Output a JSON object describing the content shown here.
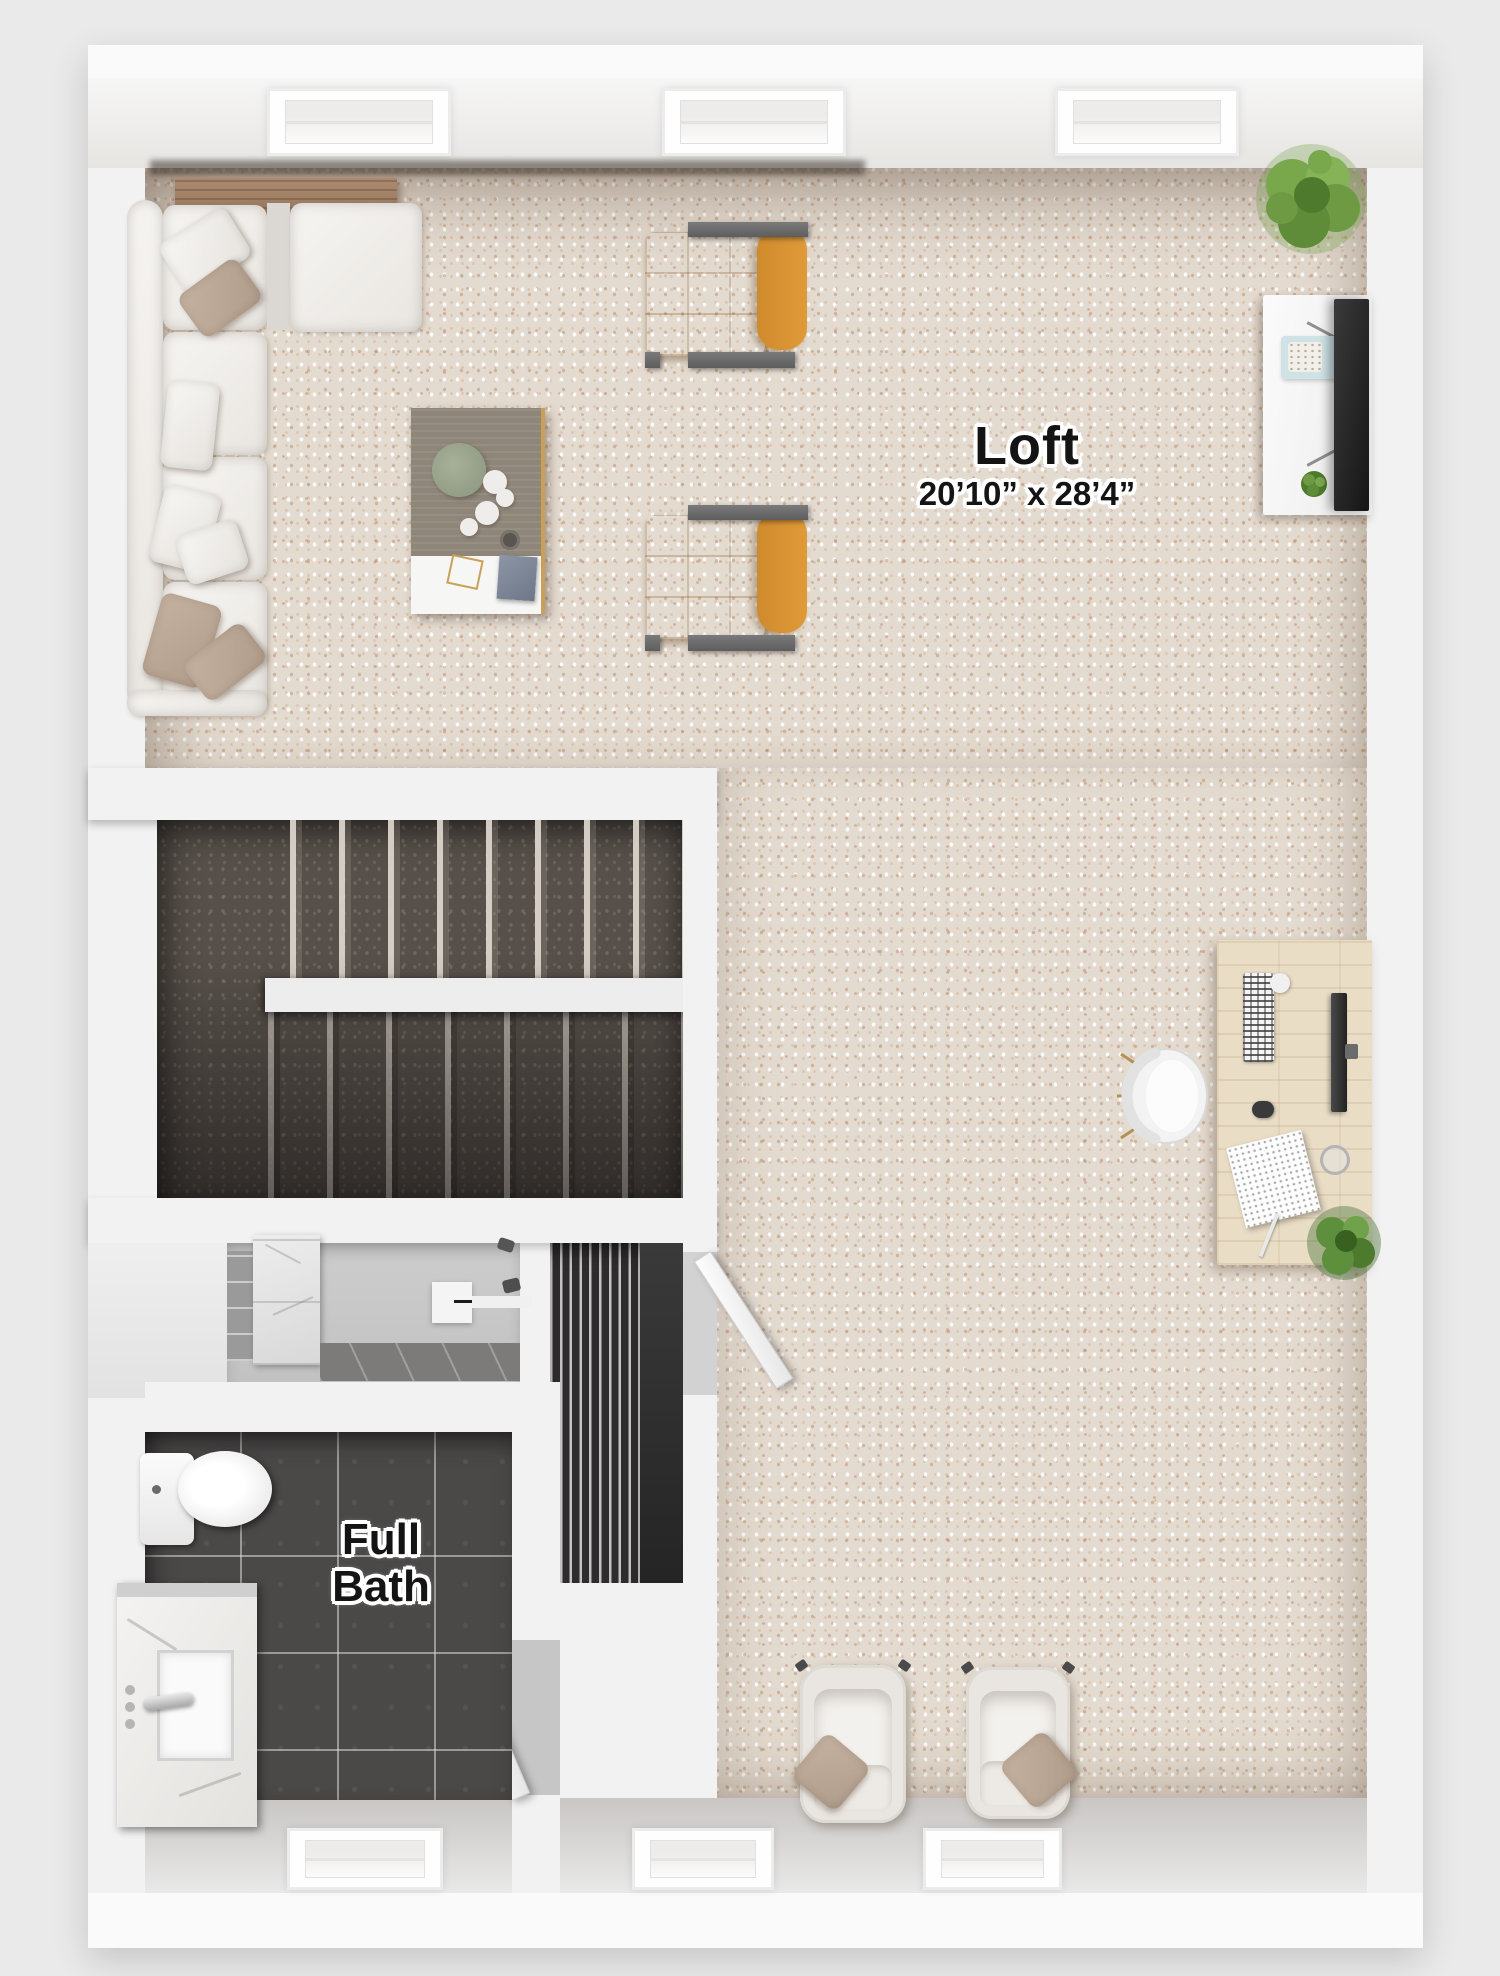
{
  "labels": {
    "loft_name": "Loft",
    "loft_dimensions": "20’10” x 28’4”",
    "bath_line1": "Full",
    "bath_line2": "Bath"
  },
  "colors": {
    "bg": "#eaeaea",
    "wall": "#f2f2f2",
    "carpet": "#e4dbd0",
    "stair_carpet": "#57504a",
    "bath_tile": "#4b4848",
    "accent": "#d9912f",
    "pillow_tan": "#c6b2a0",
    "plant_green": "#6d9a43",
    "wood_console": "#a4836a",
    "desk_wood": "#e9ddc6",
    "label": "#141414"
  },
  "furniture": [
    "sectional-sofa",
    "console-table",
    "coffee-table",
    "accent-chair",
    "accent-chair",
    "corner-plant",
    "media-console",
    "tv",
    "desk",
    "desk-chair",
    "desk-plant",
    "armchair",
    "armchair",
    "staircase",
    "louvered-closet",
    "shower",
    "toilet",
    "vanity"
  ]
}
